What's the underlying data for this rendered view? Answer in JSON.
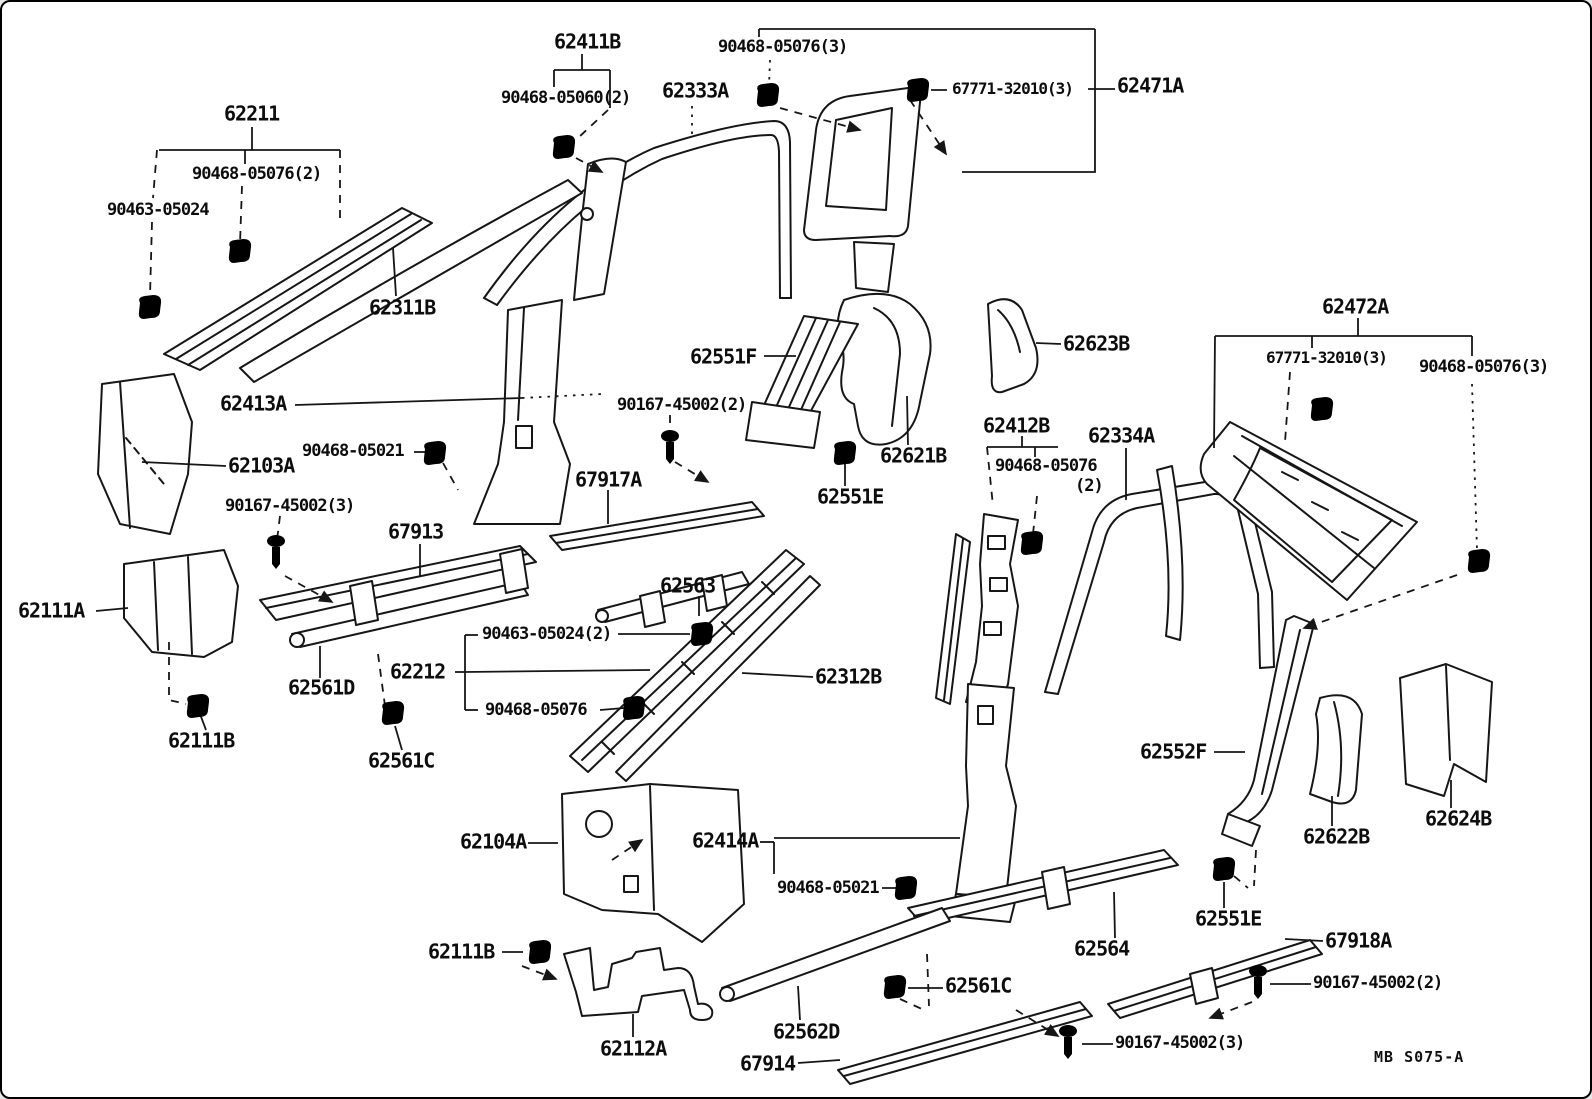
{
  "colors": {
    "ink": "#161616",
    "paper": "#ffffff"
  },
  "footer": {
    "code": "MB S075-A"
  },
  "fastener_types": {
    "clip": "trim-clip-icon",
    "screw": "tapping-screw-icon"
  },
  "labels": [
    {
      "t": "62211",
      "x": 222,
      "y": 102
    },
    {
      "t": "90468-05076(2)",
      "x": 190,
      "y": 163,
      "s": 17
    },
    {
      "t": "90463-05024",
      "x": 105,
      "y": 199,
      "s": 17
    },
    {
      "t": "62311B",
      "x": 367,
      "y": 296
    },
    {
      "t": "62411B",
      "x": 552,
      "y": 30
    },
    {
      "t": "90468-05060(2)",
      "x": 499,
      "y": 87,
      "s": 17
    },
    {
      "t": "62333A",
      "x": 660,
      "y": 79
    },
    {
      "t": "90468-05076(3)",
      "x": 716,
      "y": 36,
      "s": 17
    },
    {
      "t": "67771-32010(3)",
      "x": 950,
      "y": 79,
      "s": 16
    },
    {
      "t": "62471A",
      "x": 1115,
      "y": 74
    },
    {
      "t": "62472A",
      "x": 1320,
      "y": 295
    },
    {
      "t": "67771-32010(3)",
      "x": 1264,
      "y": 348,
      "s": 16
    },
    {
      "t": "90468-05076(3)",
      "x": 1417,
      "y": 356,
      "s": 17
    },
    {
      "t": "62413A",
      "x": 218,
      "y": 392
    },
    {
      "t": "90468-05021",
      "x": 300,
      "y": 440,
      "s": 17
    },
    {
      "t": "62103A",
      "x": 226,
      "y": 454
    },
    {
      "t": "90167-45002(3)",
      "x": 223,
      "y": 495,
      "s": 17
    },
    {
      "t": "67913",
      "x": 386,
      "y": 520
    },
    {
      "t": "67917A",
      "x": 573,
      "y": 468
    },
    {
      "t": "62551F",
      "x": 688,
      "y": 345
    },
    {
      "t": "90167-45002(2)",
      "x": 615,
      "y": 394,
      "s": 17
    },
    {
      "t": "62621B",
      "x": 878,
      "y": 444
    },
    {
      "t": "62551E",
      "x": 815,
      "y": 485
    },
    {
      "t": "62623B",
      "x": 1061,
      "y": 332
    },
    {
      "t": "62412B",
      "x": 981,
      "y": 414
    },
    {
      "t": "62334A",
      "x": 1086,
      "y": 424
    },
    {
      "t": "90468-05076",
      "x": 993,
      "y": 455,
      "s": 17
    },
    {
      "t": "(2)",
      "x": 1073,
      "y": 475,
      "s": 17
    },
    {
      "t": "62111A",
      "x": 16,
      "y": 599
    },
    {
      "t": "62212",
      "x": 388,
      "y": 660
    },
    {
      "t": "90463-05024(2)",
      "x": 480,
      "y": 623,
      "s": 17
    },
    {
      "t": "90468-05076",
      "x": 483,
      "y": 699,
      "s": 17
    },
    {
      "t": "62563",
      "x": 658,
      "y": 574
    },
    {
      "t": "62312B",
      "x": 813,
      "y": 665
    },
    {
      "t": "62561D",
      "x": 286,
      "y": 676
    },
    {
      "t": "62111B",
      "x": 166,
      "y": 729
    },
    {
      "t": "62561C",
      "x": 366,
      "y": 749
    },
    {
      "t": "62552F",
      "x": 1138,
      "y": 740
    },
    {
      "t": "62622B",
      "x": 1301,
      "y": 825
    },
    {
      "t": "62624B",
      "x": 1423,
      "y": 807
    },
    {
      "t": "62104A",
      "x": 458,
      "y": 830
    },
    {
      "t": "62414A",
      "x": 690,
      "y": 829
    },
    {
      "t": "90468-05021",
      "x": 775,
      "y": 877,
      "s": 17
    },
    {
      "t": "62111B",
      "x": 426,
      "y": 940
    },
    {
      "t": "62551E",
      "x": 1193,
      "y": 907
    },
    {
      "t": "67918A",
      "x": 1323,
      "y": 929
    },
    {
      "t": "90167-45002(2)",
      "x": 1311,
      "y": 972,
      "s": 17
    },
    {
      "t": "62564",
      "x": 1072,
      "y": 937
    },
    {
      "t": "62561C",
      "x": 943,
      "y": 974
    },
    {
      "t": "62562D",
      "x": 771,
      "y": 1020
    },
    {
      "t": "67914",
      "x": 738,
      "y": 1052
    },
    {
      "t": "90167-45002(3)",
      "x": 1113,
      "y": 1032,
      "s": 17
    },
    {
      "t": "62112A",
      "x": 598,
      "y": 1037
    }
  ],
  "lines": [
    {
      "p": [
        [
          250,
          125
        ],
        [
          250,
          148
        ]
      ]
    },
    {
      "p": [
        [
          157,
          148
        ],
        [
          338,
          148
        ]
      ]
    },
    {
      "p": [
        [
          243,
          148
        ],
        [
          243,
          162
        ]
      ]
    },
    {
      "p": [
        [
          240,
          184
        ],
        [
          238,
          242
        ]
      ],
      "d": 1
    },
    {
      "p": [
        [
          155,
          148
        ],
        [
          151,
          196
        ]
      ],
      "d": 1
    },
    {
      "p": [
        [
          150,
          220
        ],
        [
          148,
          294
        ]
      ],
      "d": 1
    },
    {
      "p": [
        [
          338,
          148
        ],
        [
          338,
          218
        ]
      ],
      "d": 1
    },
    {
      "p": [
        [
          394,
          294
        ],
        [
          391,
          246
        ]
      ]
    },
    {
      "p": [
        [
          580,
          52
        ],
        [
          580,
          68
        ]
      ]
    },
    {
      "p": [
        [
          552,
          68
        ],
        [
          608,
          68
        ]
      ]
    },
    {
      "p": [
        [
          552,
          68
        ],
        [
          552,
          85
        ]
      ]
    },
    {
      "p": [
        [
          608,
          68
        ],
        [
          608,
          106
        ]
      ]
    },
    {
      "p": [
        [
          606,
          108
        ],
        [
          576,
          136
        ]
      ],
      "d": 1
    },
    {
      "p": [
        [
          574,
          156
        ],
        [
          600,
          170
        ]
      ],
      "d": 1,
      "a": 1
    },
    {
      "p": [
        [
          690,
          104
        ],
        [
          690,
          138
        ]
      ],
      "d": 2
    },
    {
      "p": [
        [
          757,
          27
        ],
        [
          1093,
          27
        ]
      ]
    },
    {
      "p": [
        [
          757,
          27
        ],
        [
          757,
          35
        ]
      ]
    },
    {
      "p": [
        [
          1093,
          27
        ],
        [
          1093,
          170
        ],
        [
          960,
          170
        ]
      ]
    },
    {
      "p": [
        [
          768,
          58
        ],
        [
          767,
          84
        ]
      ],
      "d": 2
    },
    {
      "p": [
        [
          778,
          106
        ],
        [
          858,
          128
        ]
      ],
      "d": 1,
      "a": 1
    },
    {
      "p": [
        [
          945,
          88
        ],
        [
          929,
          88
        ]
      ]
    },
    {
      "p": [
        [
          1086,
          87
        ],
        [
          1113,
          87
        ]
      ]
    },
    {
      "p": [
        [
          908,
          98
        ],
        [
          944,
          152
        ]
      ],
      "d": 1,
      "a": 1
    },
    {
      "p": [
        [
          1356,
          316
        ],
        [
          1356,
          334
        ]
      ]
    },
    {
      "p": [
        [
          1213,
          334
        ],
        [
          1470,
          334
        ]
      ]
    },
    {
      "p": [
        [
          1310,
          334
        ],
        [
          1310,
          346
        ]
      ]
    },
    {
      "p": [
        [
          1213,
          334
        ],
        [
          1212,
          446
        ]
      ]
    },
    {
      "p": [
        [
          1470,
          334
        ],
        [
          1470,
          354
        ]
      ]
    },
    {
      "p": [
        [
          1288,
          370
        ],
        [
          1283,
          440
        ]
      ],
      "d": 1
    },
    {
      "p": [
        [
          1470,
          382
        ],
        [
          1475,
          548
        ]
      ],
      "d": 2
    },
    {
      "p": [
        [
          1455,
          573
        ],
        [
          1302,
          626
        ]
      ],
      "d": 1,
      "a": 1
    },
    {
      "p": [
        [
          293,
          403
        ],
        [
          520,
          396
        ]
      ]
    },
    {
      "p": [
        [
          520,
          396
        ],
        [
          600,
          392
        ]
      ],
      "d": 2
    },
    {
      "p": [
        [
          412,
          450
        ],
        [
          423,
          450
        ]
      ]
    },
    {
      "p": [
        [
          441,
          461
        ],
        [
          456,
          488
        ]
      ],
      "d": 1
    },
    {
      "p": [
        [
          224,
          464
        ],
        [
          140,
          460
        ]
      ]
    },
    {
      "p": [
        [
          278,
          514
        ],
        [
          275,
          538
        ]
      ],
      "d": 1
    },
    {
      "p": [
        [
          283,
          574
        ],
        [
          330,
          600
        ]
      ],
      "d": 1,
      "a": 1
    },
    {
      "p": [
        [
          418,
          542
        ],
        [
          418,
          574
        ]
      ]
    },
    {
      "p": [
        [
          606,
          488
        ],
        [
          606,
          522
        ]
      ]
    },
    {
      "p": [
        [
          697,
          594
        ],
        [
          697,
          614
        ]
      ]
    },
    {
      "p": [
        [
          762,
          354
        ],
        [
          794,
          354
        ]
      ]
    },
    {
      "p": [
        [
          668,
          413
        ],
        [
          668,
          432
        ]
      ],
      "d": 1
    },
    {
      "p": [
        [
          673,
          460
        ],
        [
          706,
          480
        ]
      ],
      "d": 1,
      "a": 1
    },
    {
      "p": [
        [
          843,
          484
        ],
        [
          843,
          462
        ]
      ]
    },
    {
      "p": [
        [
          906,
          443
        ],
        [
          905,
          394
        ]
      ]
    },
    {
      "p": [
        [
          1059,
          342
        ],
        [
          1034,
          341
        ]
      ]
    },
    {
      "p": [
        [
          1020,
          434
        ],
        [
          1020,
          445
        ]
      ]
    },
    {
      "p": [
        [
          985,
          445
        ],
        [
          1056,
          445
        ]
      ]
    },
    {
      "p": [
        [
          985,
          445
        ],
        [
          991,
          504
        ]
      ],
      "d": 1
    },
    {
      "p": [
        [
          1033,
          445
        ],
        [
          1033,
          455
        ]
      ]
    },
    {
      "p": [
        [
          1035,
          494
        ],
        [
          1031,
          532
        ]
      ],
      "d": 1
    },
    {
      "p": [
        [
          1124,
          446
        ],
        [
          1124,
          498
        ]
      ]
    },
    {
      "p": [
        [
          453,
          670
        ],
        [
          463,
          670
        ]
      ]
    },
    {
      "p": [
        [
          463,
          633
        ],
        [
          463,
          708
        ]
      ]
    },
    {
      "p": [
        [
          463,
          633
        ],
        [
          476,
          633
        ]
      ]
    },
    {
      "p": [
        [
          463,
          708
        ],
        [
          476,
          708
        ]
      ]
    },
    {
      "p": [
        [
          463,
          670
        ],
        [
          648,
          668
        ]
      ]
    },
    {
      "p": [
        [
          616,
          632
        ],
        [
          688,
          632
        ]
      ]
    },
    {
      "p": [
        [
          598,
          708
        ],
        [
          622,
          706
        ]
      ]
    },
    {
      "p": [
        [
          811,
          675
        ],
        [
          740,
          671
        ]
      ]
    },
    {
      "p": [
        [
          318,
          676
        ],
        [
          318,
          644
        ]
      ]
    },
    {
      "p": [
        [
          94,
          609
        ],
        [
          126,
          606
        ]
      ]
    },
    {
      "p": [
        [
          204,
          728
        ],
        [
          198,
          712
        ]
      ]
    },
    {
      "p": [
        [
          167,
          640
        ],
        [
          167,
          698
        ],
        [
          184,
          702
        ]
      ],
      "d": 1
    },
    {
      "p": [
        [
          400,
          748
        ],
        [
          393,
          724
        ]
      ]
    },
    {
      "p": [
        [
          376,
          652
        ],
        [
          383,
          704
        ]
      ],
      "d": 1
    },
    {
      "p": [
        [
          526,
          841
        ],
        [
          556,
          841
        ]
      ]
    },
    {
      "p": [
        [
          758,
          840
        ],
        [
          772,
          840
        ]
      ]
    },
    {
      "p": [
        [
          772,
          840
        ],
        [
          772,
          872
        ]
      ]
    },
    {
      "p": [
        [
          772,
          836
        ],
        [
          958,
          836
        ]
      ]
    },
    {
      "p": [
        [
          880,
          886
        ],
        [
          897,
          886
        ]
      ]
    },
    {
      "p": [
        [
          500,
          950
        ],
        [
          521,
          950
        ]
      ]
    },
    {
      "p": [
        [
          520,
          964
        ],
        [
          554,
          977
        ]
      ],
      "d": 1,
      "a": 1
    },
    {
      "p": [
        [
          631,
          1035
        ],
        [
          631,
          1012
        ]
      ]
    },
    {
      "p": [
        [
          798,
          1018
        ],
        [
          796,
          984
        ]
      ]
    },
    {
      "p": [
        [
          796,
          1061
        ],
        [
          838,
          1058
        ]
      ]
    },
    {
      "p": [
        [
          1113,
          936
        ],
        [
          1112,
          890
        ]
      ]
    },
    {
      "p": [
        [
          941,
          986
        ],
        [
          906,
          986
        ]
      ]
    },
    {
      "p": [
        [
          925,
          952
        ],
        [
          927,
          1004
        ]
      ],
      "d": 1
    },
    {
      "p": [
        [
          898,
          997
        ],
        [
          922,
          1008
        ]
      ],
      "d": 1
    },
    {
      "p": [
        [
          1222,
          906
        ],
        [
          1222,
          880
        ]
      ]
    },
    {
      "p": [
        [
          1254,
          848
        ],
        [
          1252,
          884
        ]
      ],
      "d": 1
    },
    {
      "p": [
        [
          1232,
          874
        ],
        [
          1246,
          886
        ]
      ],
      "d": 1
    },
    {
      "p": [
        [
          1321,
          939
        ],
        [
          1283,
          937
        ]
      ]
    },
    {
      "p": [
        [
          1309,
          982
        ],
        [
          1268,
          982
        ]
      ]
    },
    {
      "p": [
        [
          1250,
          1000
        ],
        [
          1208,
          1016
        ]
      ],
      "d": 1,
      "a": 1
    },
    {
      "p": [
        [
          1111,
          1042
        ],
        [
          1080,
          1042
        ]
      ]
    },
    {
      "p": [
        [
          1014,
          1008
        ],
        [
          1056,
          1034
        ]
      ],
      "d": 1,
      "a": 1
    },
    {
      "p": [
        [
          1330,
          824
        ],
        [
          1330,
          794
        ]
      ]
    },
    {
      "p": [
        [
          1449,
          806
        ],
        [
          1449,
          778
        ]
      ]
    },
    {
      "p": [
        [
          1212,
          750
        ],
        [
          1243,
          750
        ]
      ]
    },
    {
      "p": [
        [
          610,
          858
        ],
        [
          640,
          838
        ]
      ],
      "d": 1,
      "a": 1
    }
  ],
  "fasteners": [
    {
      "t": "clip",
      "x": 148,
      "y": 306
    },
    {
      "t": "clip",
      "x": 238,
      "y": 250
    },
    {
      "t": "clip",
      "x": 562,
      "y": 146
    },
    {
      "t": "clip",
      "x": 766,
      "y": 94
    },
    {
      "t": "clip",
      "x": 916,
      "y": 89
    },
    {
      "t": "clip",
      "x": 433,
      "y": 452
    },
    {
      "t": "clip",
      "x": 700,
      "y": 633
    },
    {
      "t": "clip",
      "x": 632,
      "y": 707
    },
    {
      "t": "clip",
      "x": 196,
      "y": 705
    },
    {
      "t": "clip",
      "x": 391,
      "y": 712
    },
    {
      "t": "clip",
      "x": 843,
      "y": 452
    },
    {
      "t": "clip",
      "x": 1030,
      "y": 542
    },
    {
      "t": "clip",
      "x": 1320,
      "y": 408
    },
    {
      "t": "clip",
      "x": 1477,
      "y": 560
    },
    {
      "t": "clip",
      "x": 1222,
      "y": 868
    },
    {
      "t": "clip",
      "x": 904,
      "y": 887
    },
    {
      "t": "clip",
      "x": 893,
      "y": 986
    },
    {
      "t": "clip",
      "x": 538,
      "y": 951
    },
    {
      "t": "screw",
      "x": 274,
      "y": 548
    },
    {
      "t": "screw",
      "x": 668,
      "y": 443
    },
    {
      "t": "screw",
      "x": 1256,
      "y": 978
    },
    {
      "t": "screw",
      "x": 1066,
      "y": 1038
    }
  ]
}
